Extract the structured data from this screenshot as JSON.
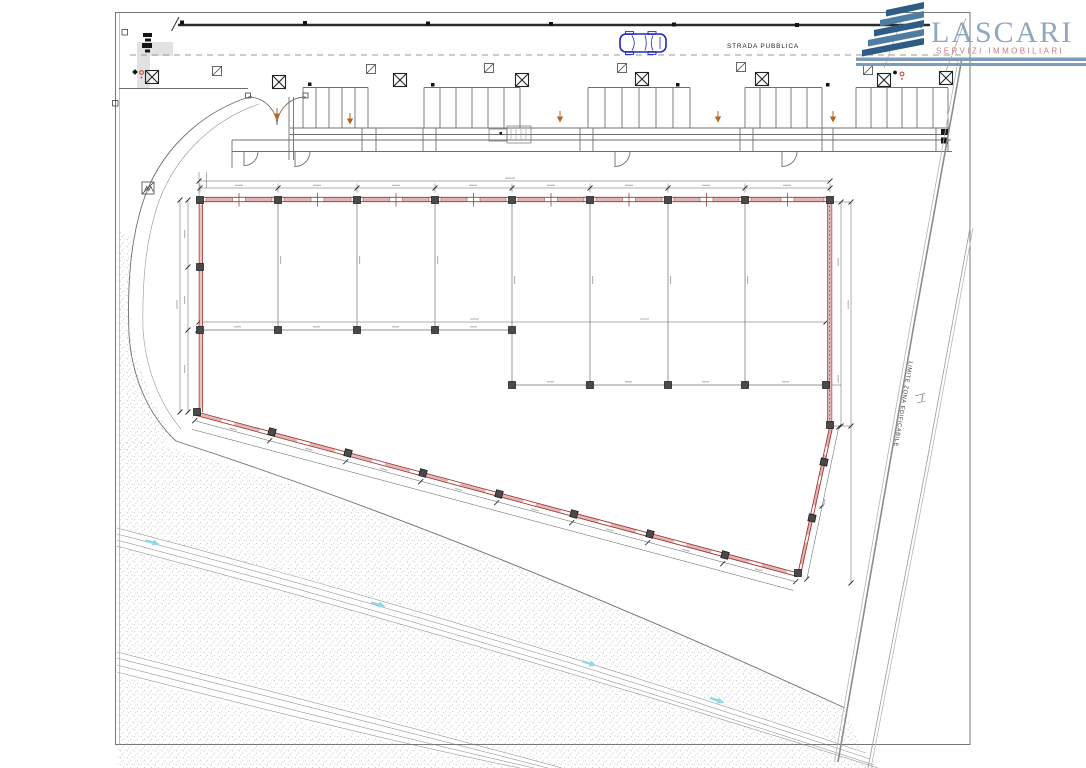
{
  "document": {
    "type": "site-plan-drawing",
    "background": "#ffffff"
  },
  "road": {
    "label": "STRADA PUBBLICA"
  },
  "boundary": {
    "label": "LIMITE ZONA EDIFICABILE"
  },
  "logo": {
    "brand": "LASCARI",
    "tagline": "SERVIZI IMMOBILIARI",
    "icon": "layered-roof-chevrons",
    "brand_color": "#8fa8bf",
    "tagline_color": "#c97d7a",
    "bar_color": "#7d9cba",
    "icon_dark": "#2e5c84",
    "icon_light": "#4d7da3"
  },
  "plan": {
    "building_outline_color": "#a33632",
    "wall_fill_color": "#e0b6b6",
    "column_color": "#4a4a4a",
    "car_color": "#2026c9",
    "flow_arrow_color": "#8fd8e4",
    "door_arrow_color": "#b5651d",
    "stipple_color": "#ababab",
    "symbols": [
      "crossed-square-marker",
      "slashed-square-marker",
      "red-hydrant-marker",
      "black-utility-marker",
      "double-swing-gate",
      "parking-stalls",
      "door-swing-arc",
      "dimension-lines",
      "flow-direction-arrows"
    ]
  }
}
